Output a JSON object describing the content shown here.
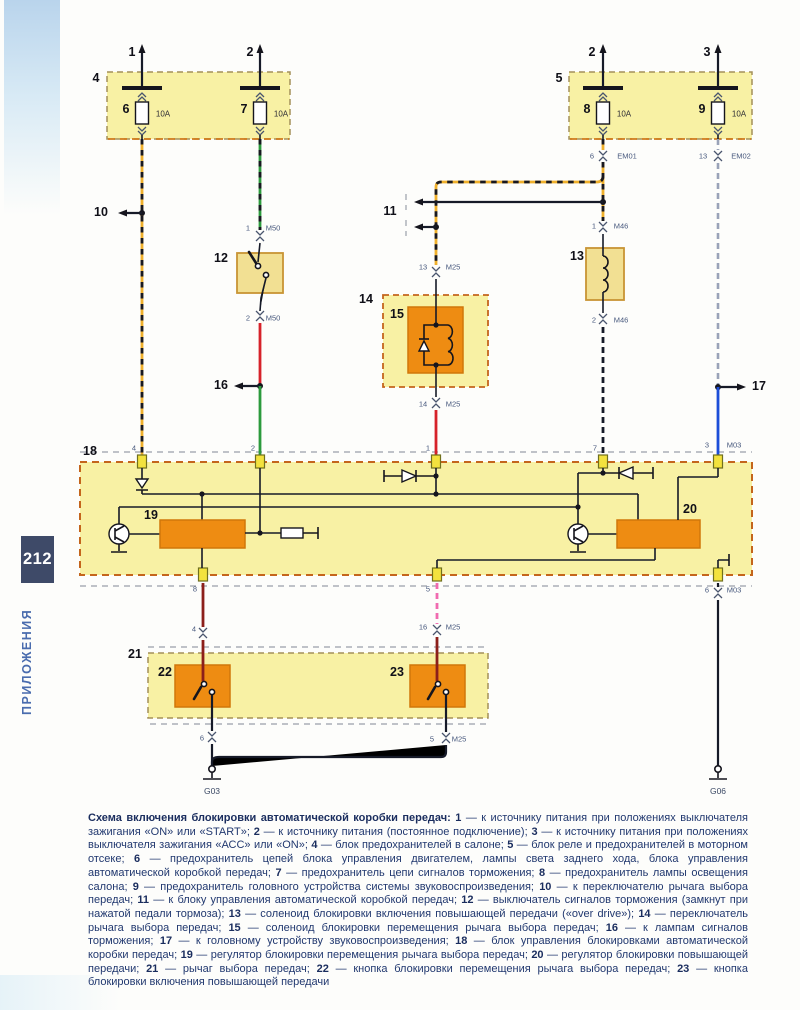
{
  "page": {
    "number": "212",
    "section": "ПРИЛОЖЕНИЯ"
  },
  "colors": {
    "black": "#161a28",
    "yellow": "#efb02c",
    "green": "#2c9a3d",
    "red": "#d6222a",
    "blue": "#1d4ed8",
    "grey": "#9aa3b8",
    "maroon": "#8c1f1a",
    "pink": "#f06bb0",
    "orange": "#ee8c12",
    "block_yellow": "#f8f1a4",
    "border_brown": "#c4651c",
    "navy_text": "#21386f",
    "page_tab": "#3e4a68"
  },
  "diagram": {
    "labels": [
      {
        "t": "1",
        "x": 132,
        "y": 52,
        "c": "num"
      },
      {
        "t": "2",
        "x": 250,
        "y": 52,
        "c": "num"
      },
      {
        "t": "2",
        "x": 592,
        "y": 52,
        "c": "num"
      },
      {
        "t": "3",
        "x": 707,
        "y": 52,
        "c": "num"
      },
      {
        "t": "4",
        "x": 96,
        "y": 78,
        "c": "num"
      },
      {
        "t": "5",
        "x": 559,
        "y": 78,
        "c": "num"
      },
      {
        "t": "6",
        "x": 126,
        "y": 109,
        "c": "num"
      },
      {
        "t": "7",
        "x": 244,
        "y": 109,
        "c": "num"
      },
      {
        "t": "8",
        "x": 587,
        "y": 109,
        "c": "num"
      },
      {
        "t": "9",
        "x": 702,
        "y": 109,
        "c": "num"
      },
      {
        "t": "10A",
        "x": 163,
        "y": 114,
        "c": "amp"
      },
      {
        "t": "10A",
        "x": 281,
        "y": 114,
        "c": "amp"
      },
      {
        "t": "10A",
        "x": 624,
        "y": 114,
        "c": "amp"
      },
      {
        "t": "10A",
        "x": 739,
        "y": 114,
        "c": "amp"
      },
      {
        "t": "10",
        "x": 101,
        "y": 212,
        "c": "num"
      },
      {
        "t": "11",
        "x": 390,
        "y": 211,
        "c": "num"
      },
      {
        "t": "12",
        "x": 221,
        "y": 258,
        "c": "num"
      },
      {
        "t": "13",
        "x": 577,
        "y": 256,
        "c": "num"
      },
      {
        "t": "14",
        "x": 366,
        "y": 299,
        "c": "num"
      },
      {
        "t": "15",
        "x": 397,
        "y": 314,
        "c": "num"
      },
      {
        "t": "16",
        "x": 221,
        "y": 385,
        "c": "num"
      },
      {
        "t": "17",
        "x": 759,
        "y": 386,
        "c": "num"
      },
      {
        "t": "18",
        "x": 90,
        "y": 451,
        "c": "num"
      },
      {
        "t": "19",
        "x": 151,
        "y": 515,
        "c": "num"
      },
      {
        "t": "20",
        "x": 690,
        "y": 509,
        "c": "num"
      },
      {
        "t": "21",
        "x": 135,
        "y": 654,
        "c": "num"
      },
      {
        "t": "22",
        "x": 165,
        "y": 672,
        "c": "num"
      },
      {
        "t": "23",
        "x": 397,
        "y": 672,
        "c": "num"
      },
      {
        "t": "1",
        "x": 248,
        "y": 228,
        "c": "pin"
      },
      {
        "t": "M50",
        "x": 273,
        "y": 228,
        "c": "pin"
      },
      {
        "t": "2",
        "x": 248,
        "y": 318,
        "c": "pin"
      },
      {
        "t": "M50",
        "x": 273,
        "y": 318,
        "c": "pin"
      },
      {
        "t": "13",
        "x": 423,
        "y": 267,
        "c": "pin"
      },
      {
        "t": "M25",
        "x": 453,
        "y": 267,
        "c": "pin"
      },
      {
        "t": "14",
        "x": 423,
        "y": 404,
        "c": "pin"
      },
      {
        "t": "M25",
        "x": 453,
        "y": 404,
        "c": "pin"
      },
      {
        "t": "6",
        "x": 592,
        "y": 156,
        "c": "pin"
      },
      {
        "t": "EM01",
        "x": 627,
        "y": 156,
        "c": "pin"
      },
      {
        "t": "13",
        "x": 703,
        "y": 156,
        "c": "pin"
      },
      {
        "t": "EM02",
        "x": 741,
        "y": 156,
        "c": "pin"
      },
      {
        "t": "1",
        "x": 594,
        "y": 226,
        "c": "pin"
      },
      {
        "t": "M46",
        "x": 621,
        "y": 226,
        "c": "pin"
      },
      {
        "t": "2",
        "x": 594,
        "y": 320,
        "c": "pin"
      },
      {
        "t": "M46",
        "x": 621,
        "y": 320,
        "c": "pin"
      },
      {
        "t": "3",
        "x": 707,
        "y": 445,
        "c": "pin"
      },
      {
        "t": "M03",
        "x": 734,
        "y": 445,
        "c": "pin"
      },
      {
        "t": "6",
        "x": 707,
        "y": 590,
        "c": "pin"
      },
      {
        "t": "M03",
        "x": 734,
        "y": 590,
        "c": "pin"
      },
      {
        "t": "4",
        "x": 194,
        "y": 629,
        "c": "pin"
      },
      {
        "t": "16",
        "x": 423,
        "y": 627,
        "c": "pin"
      },
      {
        "t": "M25",
        "x": 453,
        "y": 627,
        "c": "pin"
      },
      {
        "t": "6",
        "x": 202,
        "y": 738,
        "c": "pin"
      },
      {
        "t": "5",
        "x": 432,
        "y": 739,
        "c": "pin"
      },
      {
        "t": "M25",
        "x": 459,
        "y": 739,
        "c": "pin"
      },
      {
        "t": "4",
        "x": 134,
        "y": 448,
        "c": "pin"
      },
      {
        "t": "2",
        "x": 253,
        "y": 448,
        "c": "pin"
      },
      {
        "t": "1",
        "x": 428,
        "y": 448,
        "c": "pin"
      },
      {
        "t": "7",
        "x": 595,
        "y": 448,
        "c": "pin"
      },
      {
        "t": "8",
        "x": 195,
        "y": 589,
        "c": "pin"
      },
      {
        "t": "5",
        "x": 428,
        "y": 589,
        "c": "pin"
      },
      {
        "t": "G03",
        "x": 212,
        "y": 791,
        "c": "gnd"
      },
      {
        "t": "G06",
        "x": 718,
        "y": 791,
        "c": "gnd"
      }
    ]
  },
  "caption": {
    "lead": "Схема включения блокировки автоматической коробки передач:",
    "items": [
      {
        "n": "1",
        "t": "к источнику питания при положениях выключателя зажигания «ON» или «START»"
      },
      {
        "n": "2",
        "t": "к источнику питания (постоянное подключение)"
      },
      {
        "n": "3",
        "t": "к источнику питания при положениях выключателя зажигания «АСС» или «ON»"
      },
      {
        "n": "4",
        "t": "блок предохранителей в салоне"
      },
      {
        "n": "5",
        "t": "блок реле и предохранителей в моторном отсеке"
      },
      {
        "n": "6",
        "t": "предохранитель цепей блока управления двигателем, лампы света заднего хода, блока управления автоматической коробкой передач"
      },
      {
        "n": "7",
        "t": "предохранитель цепи сигналов торможения"
      },
      {
        "n": "8",
        "t": "предохранитель лампы освещения салона"
      },
      {
        "n": "9",
        "t": "предохранитель головного устройства системы звуковоспроизведения"
      },
      {
        "n": "10",
        "t": "к переключателю рычага выбора передач"
      },
      {
        "n": "11",
        "t": "к блоку управления автоматической коробкой передач"
      },
      {
        "n": "12",
        "t": "выключатель сигналов торможения (замкнут при нажатой педали тормоза)"
      },
      {
        "n": "13",
        "t": "соленоид блокировки включения повышающей передачи («over drive»)"
      },
      {
        "n": "14",
        "t": "переключатель рычага выбора передач"
      },
      {
        "n": "15",
        "t": "соленоид блокировки перемещения рычага выбора передач"
      },
      {
        "n": "16",
        "t": "к лампам сигналов торможения"
      },
      {
        "n": "17",
        "t": "к головному устройству звуковоспроизведения"
      },
      {
        "n": "18",
        "t": "блок управления блокировками автоматической коробки передач"
      },
      {
        "n": "19",
        "t": "регулятор блокировки перемещения рычага выбора передач"
      },
      {
        "n": "20",
        "t": "регулятор блокировки повышающей передачи"
      },
      {
        "n": "21",
        "t": "рычаг выбора передач"
      },
      {
        "n": "22",
        "t": "кнопка блокировки перемещения рычага выбора передач"
      },
      {
        "n": "23",
        "t": "кнопка блокировки включения повышающей передачи"
      }
    ]
  }
}
